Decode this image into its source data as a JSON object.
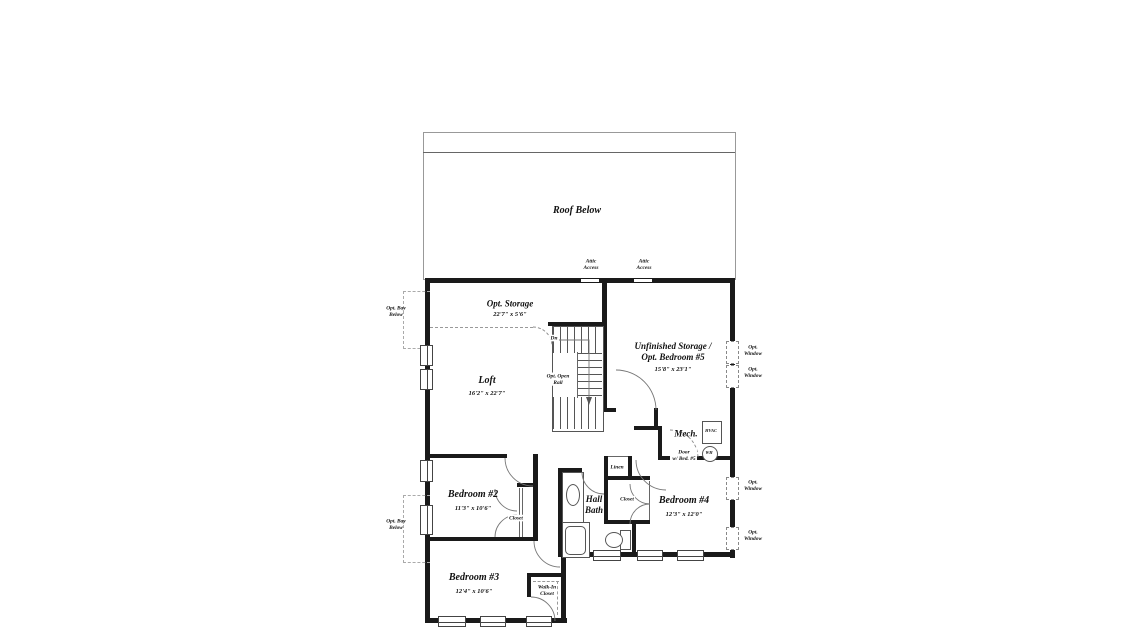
{
  "roof": {
    "label": "Roof Below"
  },
  "attic_access": {
    "left": "Attic\nAccess",
    "right": "Attic\nAccess"
  },
  "rooms": {
    "opt_storage": {
      "name": "Opt. Storage",
      "dims": "22'7\" x 5'6\""
    },
    "loft": {
      "name": "Loft",
      "dims": "16'2\" x 22'7\""
    },
    "unfinished_storage": {
      "name": "Unfinished Storage /\nOpt. Bedroom #5",
      "dims": "15'8\" x 23'1\""
    },
    "mech": {
      "name": "Mech."
    },
    "bedroom2": {
      "name": "Bedroom #2",
      "dims": "11'3\" x 10'6\""
    },
    "bedroom3": {
      "name": "Bedroom #3",
      "dims": "12'4\" x 10'6\""
    },
    "bedroom4": {
      "name": "Bedroom #4",
      "dims": "12'3\" x 12'0\""
    },
    "hall_bath": {
      "name": "Hall\nBath"
    },
    "walk_in_closet": {
      "name": "Walk-In\nCloset"
    },
    "bedroom2_closet": {
      "name": "Closet"
    },
    "bedroom4_closet": {
      "name": "Closet"
    },
    "linen": {
      "name": "Linen"
    }
  },
  "stairs": {
    "down_label": "Dn",
    "rail_label": "Opt. Open\nRail"
  },
  "equipment": {
    "hvac": "HVAC",
    "water_heater": "WH"
  },
  "annotations": {
    "door_bed5": "Door\nw/ Bed. #5",
    "opt_bay_upper": "Opt. Bay\nBelow",
    "opt_bay_lower": "Opt. Bay\nBelow",
    "opt_window_top_1": "Opt.\nWindow",
    "opt_window_top_2": "Opt.\nWindow",
    "opt_window_bottom_1": "Opt.\nWindow",
    "opt_window_bottom_2": "Opt.\nWindow"
  },
  "colors": {
    "wall": "#1a1a1a",
    "thin_line": "#666666",
    "dashed_line": "#999999",
    "paper": "#ffffff"
  }
}
